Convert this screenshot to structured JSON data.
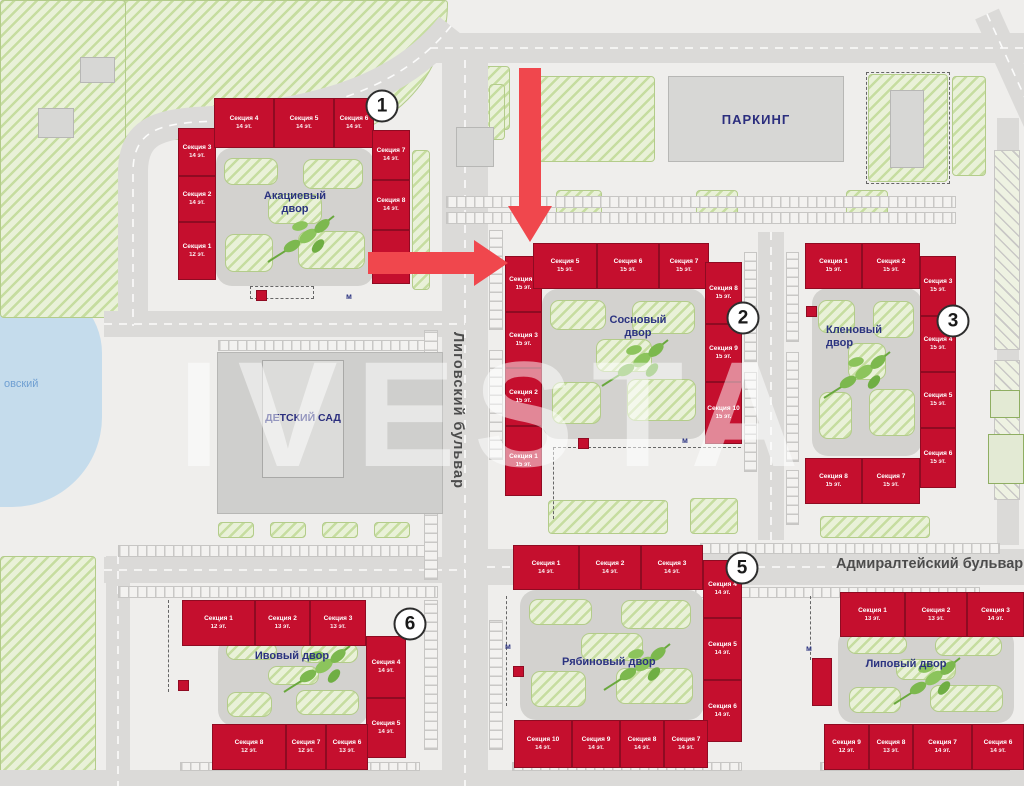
{
  "streets": {
    "ligovsky": "Лиговский бульвар",
    "admiralteysky": "Адмиралтейский бульвар"
  },
  "places": {
    "parking": "ПАРКИНГ",
    "kindergarten": "ДЕТСКИЙ САД",
    "lake": "овский"
  },
  "watermark": "IVESTA",
  "utility_marker": "м",
  "colors": {
    "building_red": "#c50f2e",
    "arrow_red": "#f0474d",
    "label_blue": "#2b3380",
    "hatch_green": "#c6dda0",
    "water_blue": "#c5dcec",
    "road_gray": "#dbdad8"
  },
  "buildings": [
    {
      "key": "b1",
      "badge": "1",
      "courtyard": "Акациевый двор",
      "sections": [
        {
          "name": "Секция 1",
          "floors": "12 эт."
        },
        {
          "name": "Секция 2",
          "floors": "14 эт."
        },
        {
          "name": "Секция 3",
          "floors": "14 эт."
        },
        {
          "name": "Секция 4",
          "floors": "14 эт."
        },
        {
          "name": "Секция 5",
          "floors": "14 эт."
        },
        {
          "name": "Секция 6",
          "floors": "14 эт."
        },
        {
          "name": "Секция 7",
          "floors": "14 эт."
        },
        {
          "name": "Секция 8",
          "floors": "14 эт."
        },
        {
          "name": "Секция 9",
          "floors": ""
        }
      ]
    },
    {
      "key": "b2",
      "badge": "2",
      "courtyard": "Сосновый двор",
      "sections": [
        {
          "name": "Секция 1",
          "floors": "15 эт."
        },
        {
          "name": "Секция 2",
          "floors": "15 эт."
        },
        {
          "name": "Секция 3",
          "floors": "15 эт."
        },
        {
          "name": "Секция 4",
          "floors": "15 эт."
        },
        {
          "name": "Секция 5",
          "floors": "15 эт."
        },
        {
          "name": "Секция 6",
          "floors": "15 эт."
        },
        {
          "name": "Секция 7",
          "floors": "15 эт."
        },
        {
          "name": "Секция 8",
          "floors": "15 эт."
        },
        {
          "name": "Секция 9",
          "floors": "15 эт."
        },
        {
          "name": "Секция 10",
          "floors": "15 эт."
        }
      ]
    },
    {
      "key": "b3",
      "badge": "3",
      "courtyard": "Кленовый двор",
      "sections": [
        {
          "name": "Секция 1",
          "floors": "15 эт."
        },
        {
          "name": "Секция 2",
          "floors": "15 эт."
        },
        {
          "name": "Секция 3",
          "floors": "15 эт."
        },
        {
          "name": "Секция 4",
          "floors": "15 эт."
        },
        {
          "name": "Секция 5",
          "floors": "15 эт."
        },
        {
          "name": "Секция 6",
          "floors": "15 эт."
        },
        {
          "name": "Секция 7",
          "floors": "15 эт."
        },
        {
          "name": "Секция 8",
          "floors": "15 эт."
        }
      ]
    },
    {
      "key": "b5",
      "badge": "5",
      "courtyard": "Рябиновый двор",
      "sections": [
        {
          "name": "Секция 1",
          "floors": "14 эт."
        },
        {
          "name": "Секция 2",
          "floors": "14 эт."
        },
        {
          "name": "Секция 3",
          "floors": "14 эт."
        },
        {
          "name": "Секция 4",
          "floors": "14 эт."
        },
        {
          "name": "Секция 5",
          "floors": "14 эт."
        },
        {
          "name": "Секция 6",
          "floors": "14 эт."
        },
        {
          "name": "Секция 7",
          "floors": "14 эт."
        },
        {
          "name": "Секция 8",
          "floors": "14 эт."
        },
        {
          "name": "Секция 9",
          "floors": "14 эт."
        },
        {
          "name": "Секция 10",
          "floors": "14 эт."
        }
      ]
    },
    {
      "key": "b6",
      "badge": "6",
      "courtyard": "Ивовый двор",
      "sections": [
        {
          "name": "Секция 1",
          "floors": "12 эт."
        },
        {
          "name": "Секция 2",
          "floors": "13 эт."
        },
        {
          "name": "Секция 3",
          "floors": "13 эт."
        },
        {
          "name": "Секция 4",
          "floors": "14 эт."
        },
        {
          "name": "Секция 5",
          "floors": "14 эт."
        },
        {
          "name": "Секция 6",
          "floors": "13 эт."
        },
        {
          "name": "Секция 7",
          "floors": "12 эт."
        },
        {
          "name": "Секция 8",
          "floors": "12 эт."
        }
      ]
    },
    {
      "key": "b7",
      "badge": "",
      "courtyard": "Липовый двор",
      "sections": [
        {
          "name": "Секция 1",
          "floors": "13 эт."
        },
        {
          "name": "Секция 2",
          "floors": "13 эт."
        },
        {
          "name": "Секция 3",
          "floors": "14 эт."
        },
        {
          "name": "Секция 6",
          "floors": "14 эт."
        },
        {
          "name": "Секция 7",
          "floors": "14 эт."
        },
        {
          "name": "Секция 8",
          "floors": "13 эт."
        },
        {
          "name": "Секция 9",
          "floors": "12 эт."
        }
      ]
    }
  ]
}
